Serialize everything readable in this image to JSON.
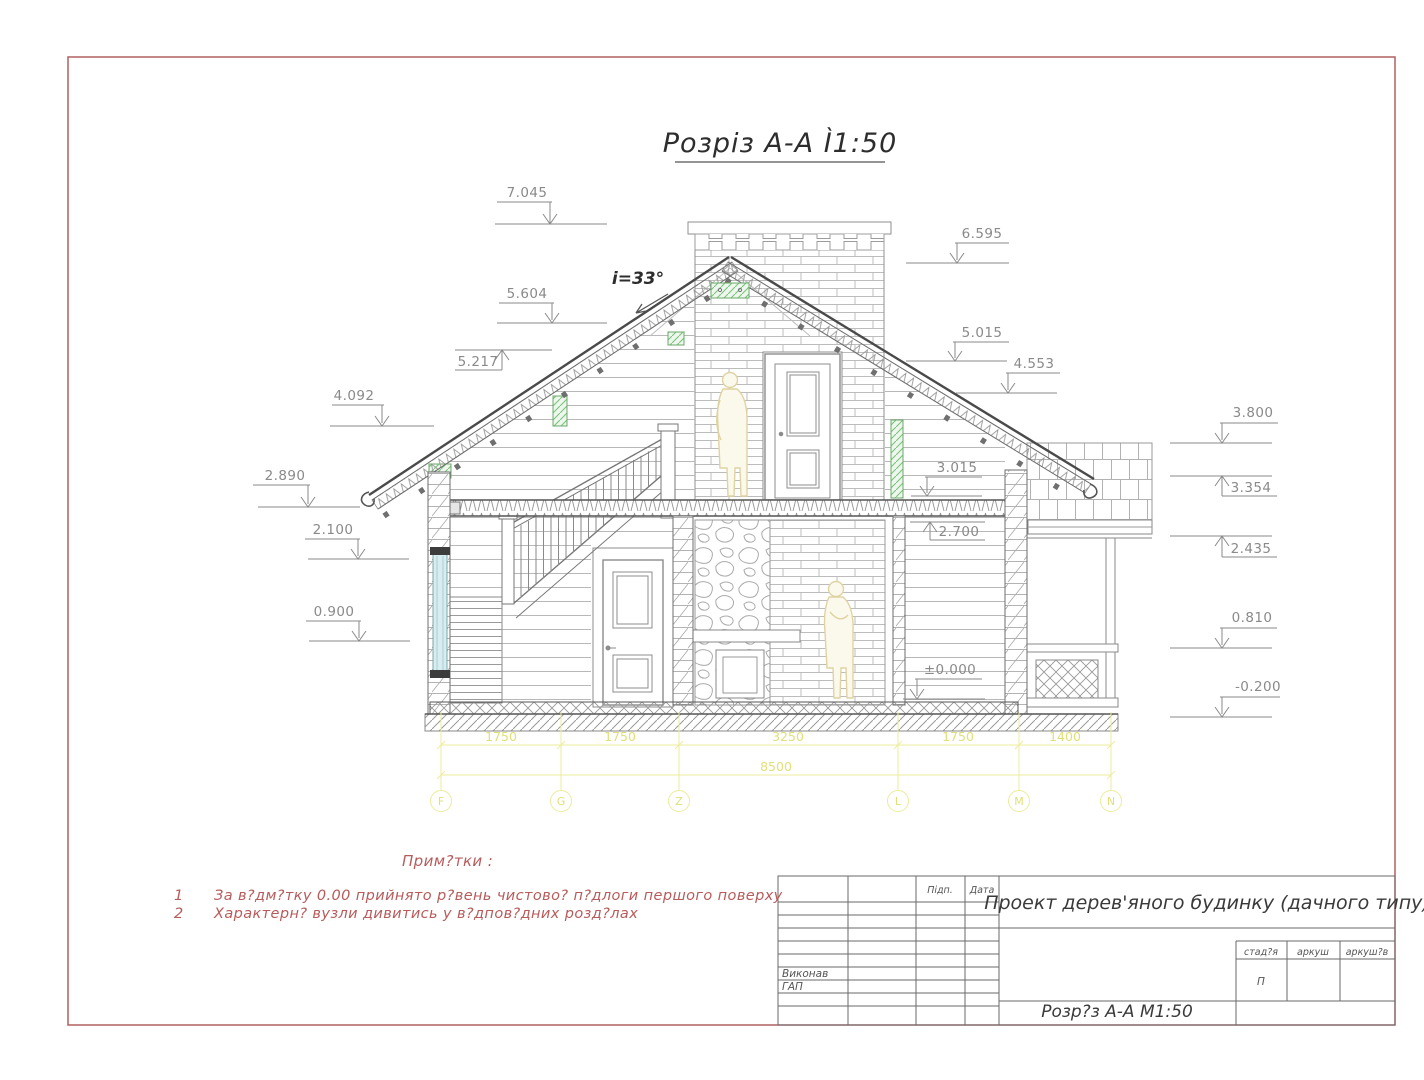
{
  "sheet": {
    "title": "Розріз А-А Ì1:50",
    "slope_label": "i=33°"
  },
  "elevation_marks": {
    "left": [
      "7.045",
      "5.604",
      "5.217",
      "4.092",
      "2.890",
      "2.100",
      "0.900"
    ],
    "right_upper": [
      "6.595",
      "5.015",
      "4.553"
    ],
    "right_lower": [
      "3.800",
      "3.354",
      "2.435",
      "0.810",
      "-0.200"
    ],
    "middle": [
      "3.015",
      "2.700",
      "±0.000"
    ]
  },
  "dimensions": {
    "segments": [
      "1750",
      "1750",
      "3250",
      "1750",
      "1400"
    ],
    "total": "8500"
  },
  "grid_axes": [
    "F",
    "G",
    "Z",
    "L",
    "M",
    "N"
  ],
  "notes": {
    "heading": "Прим?тки :",
    "items": [
      {
        "num": "1",
        "text": "За в?дм?тку 0.00  прийнято р?вень чистово?  п?длоги першого поверху"
      },
      {
        "num": "2",
        "text": "Характерн?  вузли  дивитись  у  в?дпов?дних  розд?лах"
      }
    ]
  },
  "title_block": {
    "project": "Проект дерев'яного будинку (дачного типу)",
    "drawing_title": "Розр?з А-А М1:50",
    "sign_label": "Підп.",
    "date_label": "Дата",
    "executor_label": "Виконав",
    "gap_label": "ГАП",
    "stage_label": "стад?я",
    "sheet_label": "аркуш",
    "sheets_label": "аркуш?в",
    "stage_value": "П"
  },
  "colors": {
    "border": "#b06060",
    "notes_red": "#b75b5b",
    "dim_yellow": "#ecec9e",
    "line_gray": "#8a8a8a",
    "green": "#86c786",
    "window_blue": "#d8edf0",
    "figure_beige": "#e0d3a2"
  }
}
